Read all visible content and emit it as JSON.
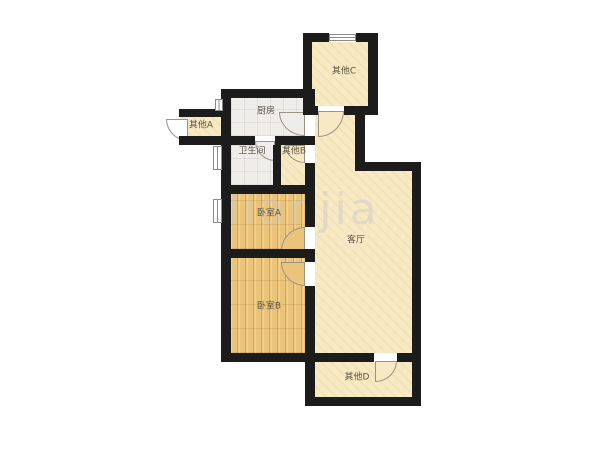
{
  "title": "apartment-floorplan",
  "watermark": {
    "text": "lianjia"
  },
  "rooms": {
    "other_a": {
      "label": "其他A"
    },
    "kitchen": {
      "label": "厨房"
    },
    "other_c": {
      "label": "其他C"
    },
    "bathroom": {
      "label": "卫生间"
    },
    "other_b": {
      "label": "其他B"
    },
    "bedroom_a": {
      "label": "卧室A"
    },
    "living": {
      "label": "客厅"
    },
    "bedroom_b": {
      "label": "卧室B"
    },
    "other_d": {
      "label": "其他D"
    }
  },
  "colors": {
    "wall": "#1c1c1c",
    "floor_beige": "#f7e9c3",
    "floor_wood": "#eac47a",
    "floor_tile": "#efedea",
    "label_text": "#5d5647",
    "watermark": "#c9c9c9",
    "background": "#ffffff"
  }
}
